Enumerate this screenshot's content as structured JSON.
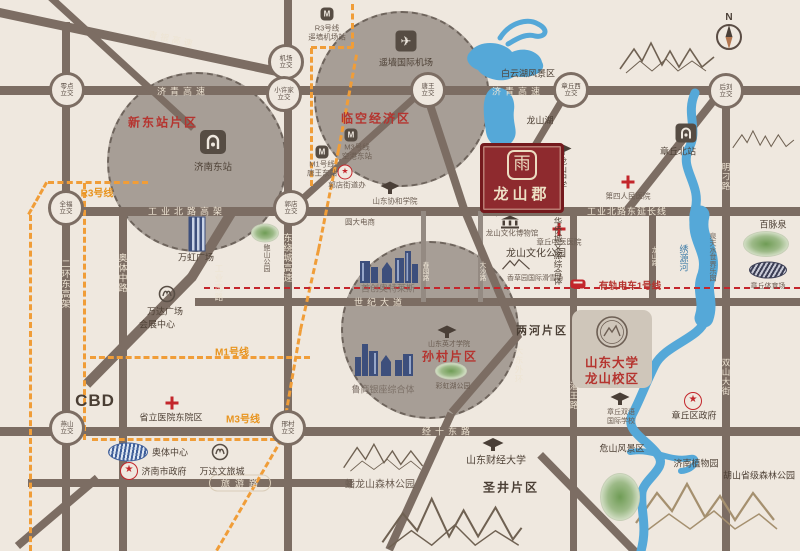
{
  "compass": {
    "label": "N"
  },
  "logo": {
    "seal": "雨",
    "name": "龙山郡"
  },
  "districts": {
    "xindongzhan": "新东站片区",
    "linkong": "临空经济区",
    "suncun": "孙村片区",
    "lianghe": "两河片区",
    "shengjing": "圣井片区",
    "cbd": "CBD"
  },
  "roads": {
    "qingyin": "青银高速",
    "jiqing": "济青高速",
    "gongyebei_viaduct": "工业北路高架",
    "gongyebei_ext": "工业北路东延长线",
    "shiji_avenue": "世纪大道",
    "jingshi_east": "经十东路",
    "lvyou": "旅游路",
    "erhuan_east": "二环东高架",
    "aoti_middle": "奥体中路",
    "raocheng_east": "东绕城高速",
    "dadong_outer": "大东外环",
    "gongye_south": "工业南路",
    "mingdiao": "明刁路",
    "shuangshan": "双山大街",
    "panwang": "潘王路",
    "chunyuan": "春园路",
    "dasha": "大沙路",
    "longshan_road": "龙山路"
  },
  "interchanges": {
    "lingdian": {
      "n": "零点",
      "s": "立交"
    },
    "jichang": {
      "n": "机场",
      "s": "立交"
    },
    "xiaoxujia": {
      "n": "小许家",
      "s": "立交"
    },
    "tangwang": {
      "n": "唐王",
      "s": "立交"
    },
    "zhangqiuxi": {
      "n": "章丘西",
      "s": "立交"
    },
    "houliu": {
      "n": "后刘",
      "s": "立交"
    },
    "quanfu": {
      "n": "全福",
      "s": "立交"
    },
    "guodian": {
      "n": "郭店",
      "s": "立交"
    },
    "yanshan": {
      "n": "燕山",
      "s": "立交"
    },
    "xingcun": {
      "n": "邢村",
      "s": "立交"
    }
  },
  "transit": {
    "r3_label": "R3号线",
    "m1_label": "M1号线",
    "m3_label": "M3号线",
    "r3_station": {
      "line": "R3号线",
      "station": "遥墙机场站"
    },
    "m3_station": {
      "line": "M3号线",
      "station": "空港东站"
    },
    "m1_station": {
      "line": "M1号线",
      "station": "唐王东站"
    },
    "tram_line": "有轨电车1号线"
  },
  "stations": {
    "jinan_east": "济南东站",
    "zhangqiu_north": "章丘北站"
  },
  "water": {
    "baiyun_lake": "白云湖风景区",
    "longshan_lake": "龙山湖",
    "xiuyuan_river": "绣源河"
  },
  "pois": {
    "airport": "遥墙国际机场",
    "wanhong_plaza": "万虹广场",
    "baoshan_park": "鲍山公园",
    "xiehe_college": "山东协和学院",
    "yuanda_ec": "圆大电商",
    "guodian_office": "郭店街道办",
    "wanda_plaza": "万达广场",
    "exhibition_center": "会展中心",
    "shengli_hospital": "省立医院东院区",
    "aoti_center": "奥体中心",
    "jinan_gov": "济南市政府",
    "wanda_cultural_city": "万达文旅城",
    "shouchuang_outlets": "首创奥特莱斯",
    "yingcai_college": "山东英才学院",
    "caihong_park": "彩虹湖公园",
    "lushang_complex": "鲁商银座综合体",
    "panlongshan_park": "蟠龙山森林公园",
    "caijing_univ": "山东财经大学",
    "longshan_middle_school": "龙山中学",
    "longshan_museum": "龙山文化博物馆",
    "zhangqiu_tcm_hospital": "章丘中医医院",
    "longshan_culture_park": "龙山文化公园",
    "xiangcaoyuan": "香草园国际滑雪场",
    "renmin_hospital": "第四人民医院",
    "huaqiaocheng": "华侨城文旅综合体",
    "baimaiquan": "百脉泉",
    "zhangqiu_stadium": "章丘体育场",
    "quantian_waterpark": "泉天水世界乐园",
    "sdu": {
      "l1": "山东大学",
      "l2": "龙山校区"
    },
    "zq_bilingual": {
      "l1": "章丘双语",
      "l2": "国际学校"
    },
    "zhangqiu_gov": "章丘区政府",
    "weishan_scenic": "危山风景区",
    "botanical_garden": "济南植物园",
    "hushan_forest": "胡山省级森林公园"
  },
  "icons": {
    "airplane": "✈",
    "star": "★"
  },
  "colors": {
    "background": "#efe8df",
    "road": "#7c6d63",
    "metro_orange": "#f09d38",
    "brand_red": "#8e2a2e",
    "accent_red": "#c3262b",
    "water_blue": "#55a8d8",
    "district_text_red": "#b5342f",
    "circle_fill": "#a79e96"
  }
}
